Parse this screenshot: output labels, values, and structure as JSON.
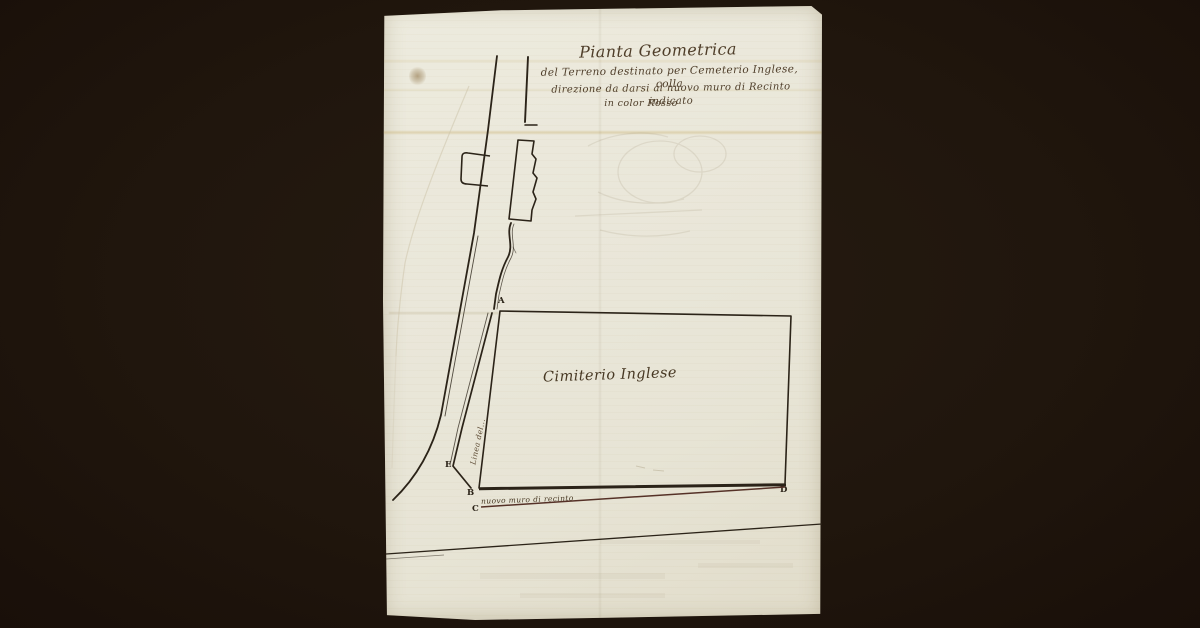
{
  "title": {
    "line1": "Pianta Geometrica",
    "line2": "del Terreno destinato per Cemeterio Inglese, colla",
    "line3": "direzione da darsi al nuovo muro di Recinto indicato",
    "line4": "in color Rosso"
  },
  "map": {
    "cemetery_label": "Cimiterio Inglese",
    "new_wall_label": "nuovo muro di recinto",
    "side_annotation": "Linea del...",
    "corner_labels": {
      "a": "A",
      "b": "B",
      "c": "C",
      "d": "D",
      "e": "E"
    }
  },
  "colors": {
    "background": "#20160d",
    "paper": "#eae7da",
    "ink": "#2b2318",
    "script_ink": "#4f3e2a",
    "red_wall": "#553127"
  }
}
